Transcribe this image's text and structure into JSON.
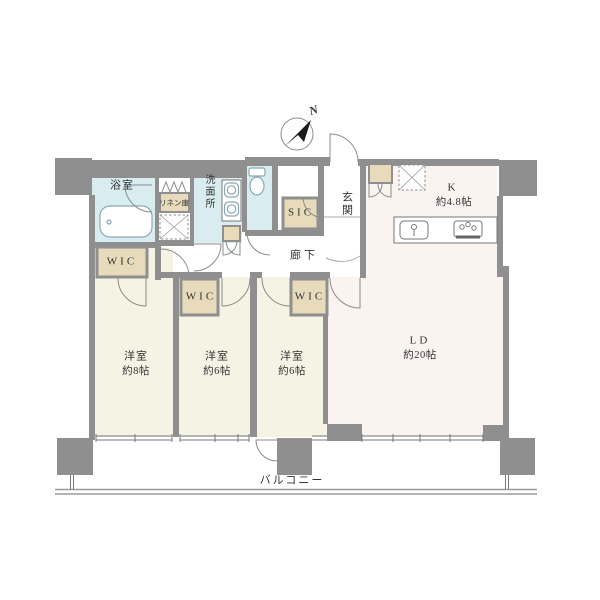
{
  "palette": {
    "wall": "#8f8f8f",
    "room_cream": "#f5f3e3",
    "water_blue": "#d9edf1",
    "closet_beige": "#e7dbbc",
    "living_pink": "#faf3f0",
    "fixture_blue": "#8aa9b5",
    "text": "#333333"
  },
  "compass": {
    "north_label": "N"
  },
  "rooms": {
    "bathroom": {
      "label": "浴室"
    },
    "washroom": {
      "label": "洗面所"
    },
    "linen": {
      "label": "リネン庫"
    },
    "wic1": {
      "label": "WIC"
    },
    "wic2": {
      "label": "WIC"
    },
    "wic3": {
      "label": "WIC"
    },
    "sic": {
      "label": "SIC"
    },
    "entrance": {
      "label": "玄関"
    },
    "corridor": {
      "label": "廊下"
    },
    "kitchen": {
      "label": "K",
      "size": "約4.8帖"
    },
    "living": {
      "label": "LD",
      "size": "約20帖"
    },
    "bedroom1": {
      "label": "洋室",
      "size": "約8帖"
    },
    "bedroom2": {
      "label": "洋室",
      "size": "約6帖"
    },
    "bedroom3": {
      "label": "洋室",
      "size": "約6帖"
    },
    "balcony": {
      "label": "バルコニー"
    }
  }
}
